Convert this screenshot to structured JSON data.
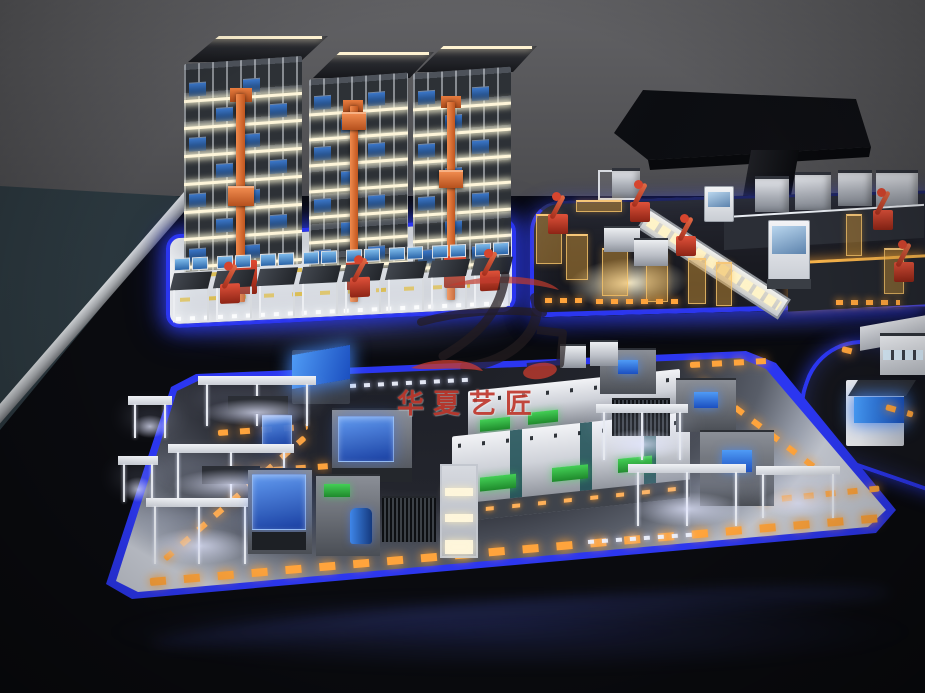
{
  "meta": {
    "type": "photograph",
    "subject": "Illuminated scale model of a smart factory exhibition table in a dark showroom"
  },
  "watermark": {
    "text": "华夏艺匠",
    "logo": "calligraphy-seal-mark",
    "color": "#c0392e"
  },
  "palette": {
    "ledBlue": "#2b36f0",
    "ledGlow": "#4b5cff",
    "amber": "#ffa43c",
    "craneOrange": "#e0713a",
    "robotRed": "#cf3a28",
    "rackBlue": "#2d62ae",
    "screenBlue": "#3f8df0",
    "screenGreen": "#2fae3e",
    "windowBlue": "#d2e7f6",
    "acrylicBlue": "#2f66d9",
    "wallGray": "#58585b",
    "tableBlack": "#0a0b0f",
    "floorLight": "#c6cad3",
    "slate": "#2a3840",
    "bandGray": "#b9bcc0",
    "watermarkRed": "#c0392e"
  },
  "scene": {
    "asrs": {
      "label": "automated storage and retrieval warehouse model",
      "towers": 3,
      "rack_levels": 7,
      "cranes": 3,
      "workstations": 8,
      "robots": 3,
      "platform_outline": "blue LED strip"
    },
    "assembly": {
      "label": "fenced robot assembly cell model",
      "robots": 5,
      "cabins": 2,
      "window_rows": 2,
      "fences": "translucent amber safety fencing",
      "platform_outline": "blue LED strip"
    },
    "display_stand": {
      "label": "large overhead display panel on pedestal"
    },
    "production": {
      "label": "production line platform model",
      "machines": "CNC line with green status screens, blue acrylic enclosures, canopy stations",
      "floor_markings": "amber dashed AGV paths, white LED dots",
      "platform_outline": "blue LED strip"
    },
    "right_platform": {
      "label": "partial platform with glowing blue machine"
    }
  }
}
